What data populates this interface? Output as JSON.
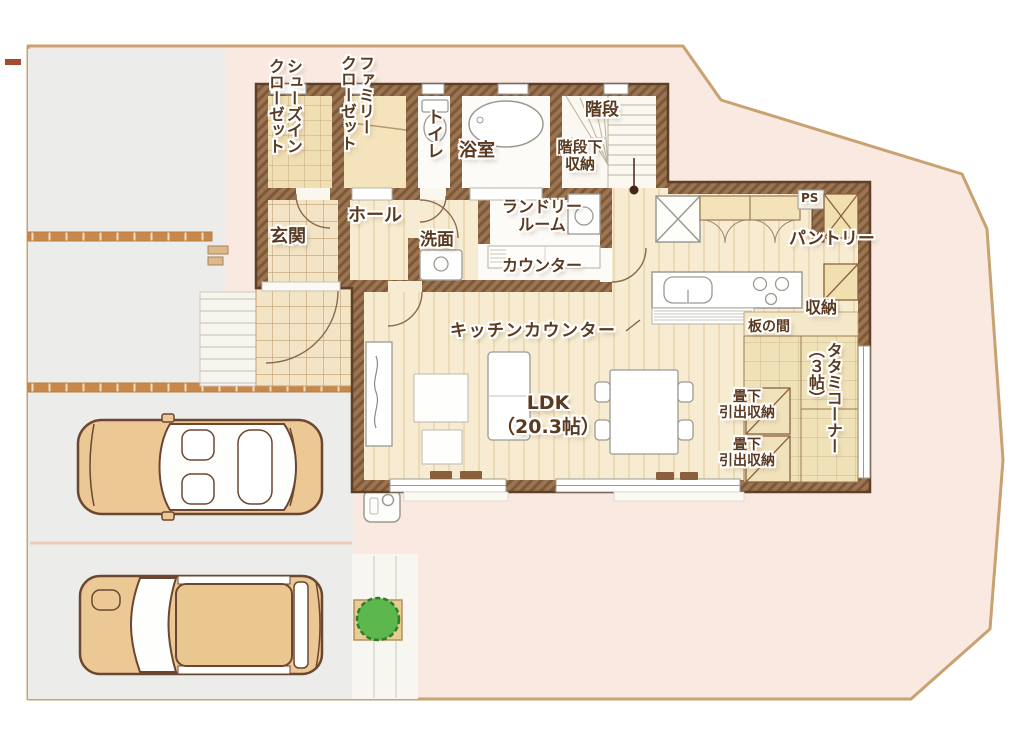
{
  "plan_type": "floor-plan-1f",
  "colors": {
    "site_fill": "#f9e9e1",
    "boundary_line": "#c9a271",
    "parking_gray": "#ececea",
    "brick_divider": "#c8874b",
    "wall_brown": "#9b7452",
    "wall_outline": "#5e4027",
    "floor_cream": "#f7ecd1",
    "tile_tan": "#f2e4c4",
    "tatami_tan": "#f0e2b8",
    "label_text": "#5a3a20",
    "car_body": "#ecc894",
    "bush_green": "#5cb84c"
  },
  "labels": {
    "shoes_closet": "シューズイン\nクローゼット",
    "family_closet": "ファミリー\nクローゼット",
    "toilet": "トイレ",
    "bath": "浴室",
    "stairs": "階段",
    "under_stairs": "階段下\n収納",
    "entrance": "玄関",
    "hall": "ホール",
    "washroom": "洗面",
    "laundry": "ランドリー\nルーム",
    "laundry_counter": "カウンター",
    "ps": "PS",
    "pantry": "パントリー",
    "storage": "収納",
    "itanoma": "板の間",
    "kitchen_counter": "キッチンカウンター",
    "ldk": "LDK\n（20.3帖）",
    "tatami_corner": "タタミコーナー\n（３帖）",
    "tatami_drawer_1": "畳下\n引出収納",
    "tatami_drawer_2": "畳下\n引出収納"
  }
}
